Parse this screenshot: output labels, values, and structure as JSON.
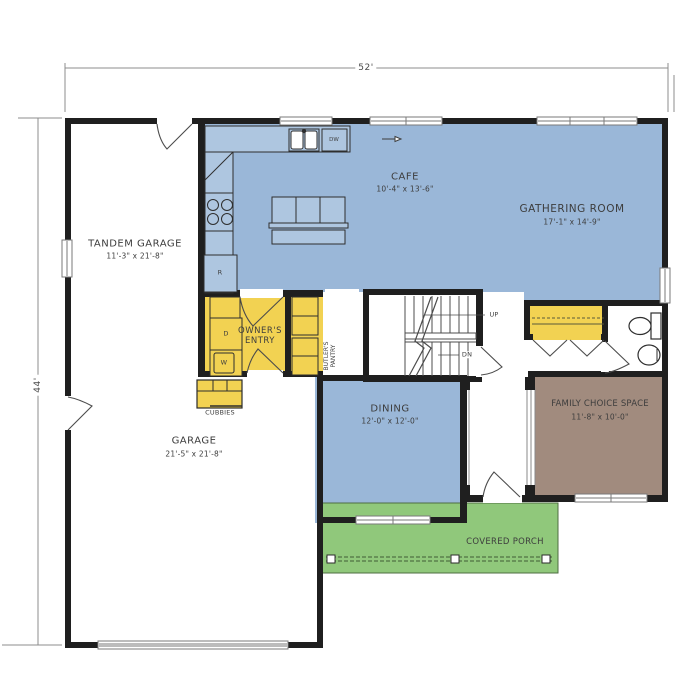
{
  "plan_dimensions": {
    "width": "52'",
    "height": "44'"
  },
  "rooms": {
    "tandem_garage": {
      "name": "TANDEM GARAGE",
      "dims": "11'-3\" x 21'-8\""
    },
    "garage": {
      "name": "GARAGE",
      "dims": "21'-5\" x 21'-8\""
    },
    "cafe": {
      "name": "CAFE",
      "dims": "10'-4\" x 13'-6\""
    },
    "gathering_room": {
      "name": "GATHERING ROOM",
      "dims": "17'-1\" x 14'-9\""
    },
    "dining": {
      "name": "DINING",
      "dims": "12'-0\" x 12'-0\""
    },
    "family_choice_space": {
      "name": "FAMILY CHOICE SPACE",
      "dims": "11'-8\" x 10'-0\""
    },
    "owners_entry": {
      "name": "OWNER'S ENTRY"
    },
    "butlers_pantry": {
      "name": "BUTLER'S PANTRY"
    },
    "covered_porch": {
      "name": "COVERED PORCH"
    },
    "cubbies": {
      "name": "CUBBIES"
    }
  },
  "stair_labels": {
    "up": "UP",
    "down": "DN"
  },
  "appliance_labels": {
    "dryer": "D",
    "washer": "W",
    "range": "R",
    "dishwasher": "DW"
  },
  "colors": {
    "living_blue": "#9ab7d8",
    "counter_blue": "#aec6e0",
    "utility_yellow": "#f2d252",
    "porch_green": "#90c87b",
    "flex_brown": "#a18b7e",
    "wall_black": "#1f1f1f"
  }
}
